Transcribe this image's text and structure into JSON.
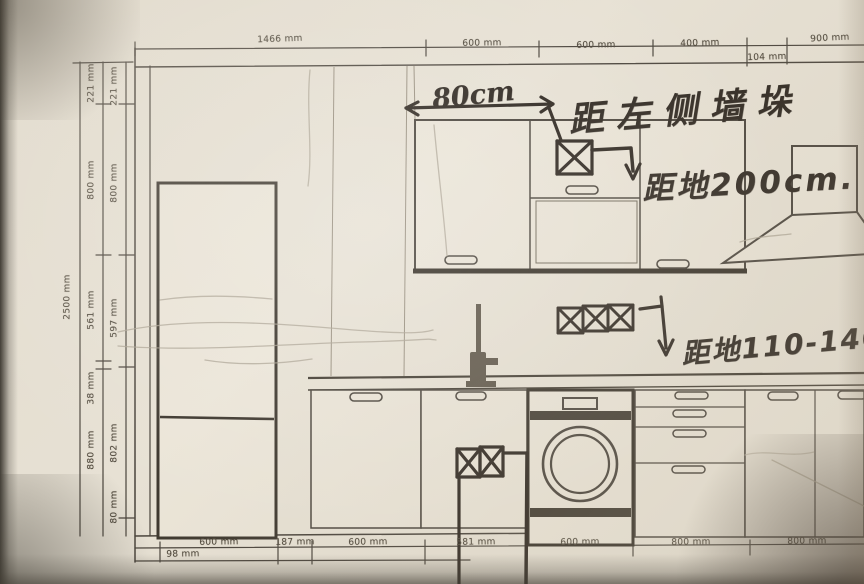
{
  "page": {
    "description": "Hand-annotated kitchen cabinetry elevation drawing (photographed blueprint)",
    "units": "mm"
  },
  "dims": {
    "top": [
      "1466 mm",
      "600 mm",
      "600 mm",
      "400 mm",
      "104 mm",
      "900 mm"
    ],
    "left_total": "2500 mm",
    "left_mid": [
      "221 mm",
      "800 mm",
      "561 mm",
      "38 mm",
      "880 mm"
    ],
    "left_inner": [
      "221 mm",
      "800 mm",
      "597 mm",
      "802 mm",
      "80 mm"
    ],
    "bottom_offset": "98 mm",
    "bottom": [
      "600 mm",
      "187 mm",
      "600 mm",
      "581 mm",
      "600 mm",
      "800 mm",
      "800 mm"
    ]
  },
  "notes": {
    "span_label": "80cm",
    "wall_note": "距左侧墙垛",
    "hood_socket_note": "距地200cm.",
    "counter_socket_note": "距地110-140"
  },
  "symbols": {
    "socket_single": "power-outlet-icon",
    "socket_triple": "triple-power-outlet-icon",
    "socket_double": "double-power-outlet-icon"
  },
  "colors": {
    "paper": "#e7e1d4",
    "print_line": "#48423a",
    "heavy_line": "#3b352c",
    "ink": "#2b241d",
    "pencil": "#aaa292"
  }
}
